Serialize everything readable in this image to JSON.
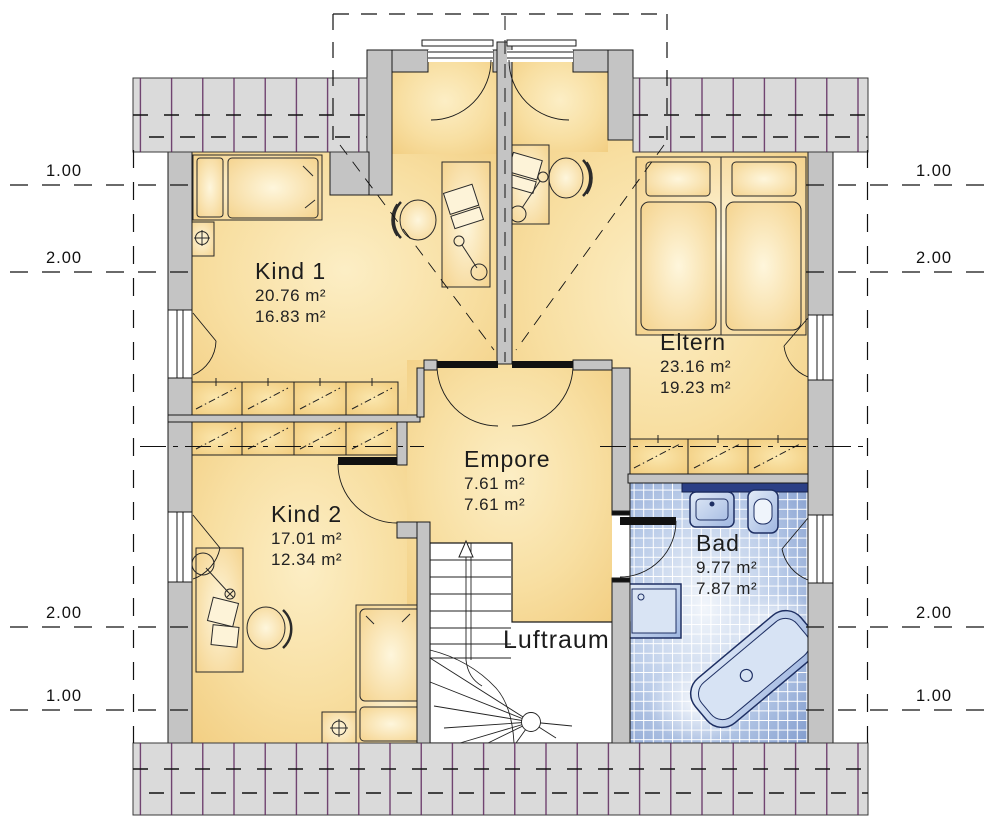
{
  "plan": {
    "rooms": [
      {
        "id": "kind1",
        "label": "Kind 1",
        "area_gross": "20.76 m²",
        "area_net": "16.83 m²"
      },
      {
        "id": "eltern",
        "label": "Eltern",
        "area_gross": "23.16 m²",
        "area_net": "19.23 m²"
      },
      {
        "id": "kind2",
        "label": "Kind 2",
        "area_gross": "17.01 m²",
        "area_net": "12.34 m²"
      },
      {
        "id": "empore",
        "label": "Empore",
        "area_gross": "7.61 m²",
        "area_net": "7.61 m²"
      },
      {
        "id": "bad",
        "label": "Bad",
        "area_gross": "9.77 m²",
        "area_net": "7.87 m²"
      },
      {
        "id": "luftraum",
        "label": "Luftraum"
      }
    ],
    "dimension_labels": {
      "left": [
        "1.00",
        "2.00",
        "2.00",
        "1.00"
      ],
      "right": [
        "1.00",
        "2.00",
        "2.00",
        "1.00"
      ]
    },
    "colors": {
      "room_fill": "#F4D189",
      "room_highlight": "#FCEFC8",
      "wall": "#C4C4C4",
      "roof_band": "#DADADA",
      "roof_hatch_line": "#5E2A5E",
      "bath_tile": "#8BA3D4",
      "bath_fixture": "#C9D8EF",
      "bath_counter": "#2B3F85",
      "line": "#1A1A1A"
    }
  }
}
